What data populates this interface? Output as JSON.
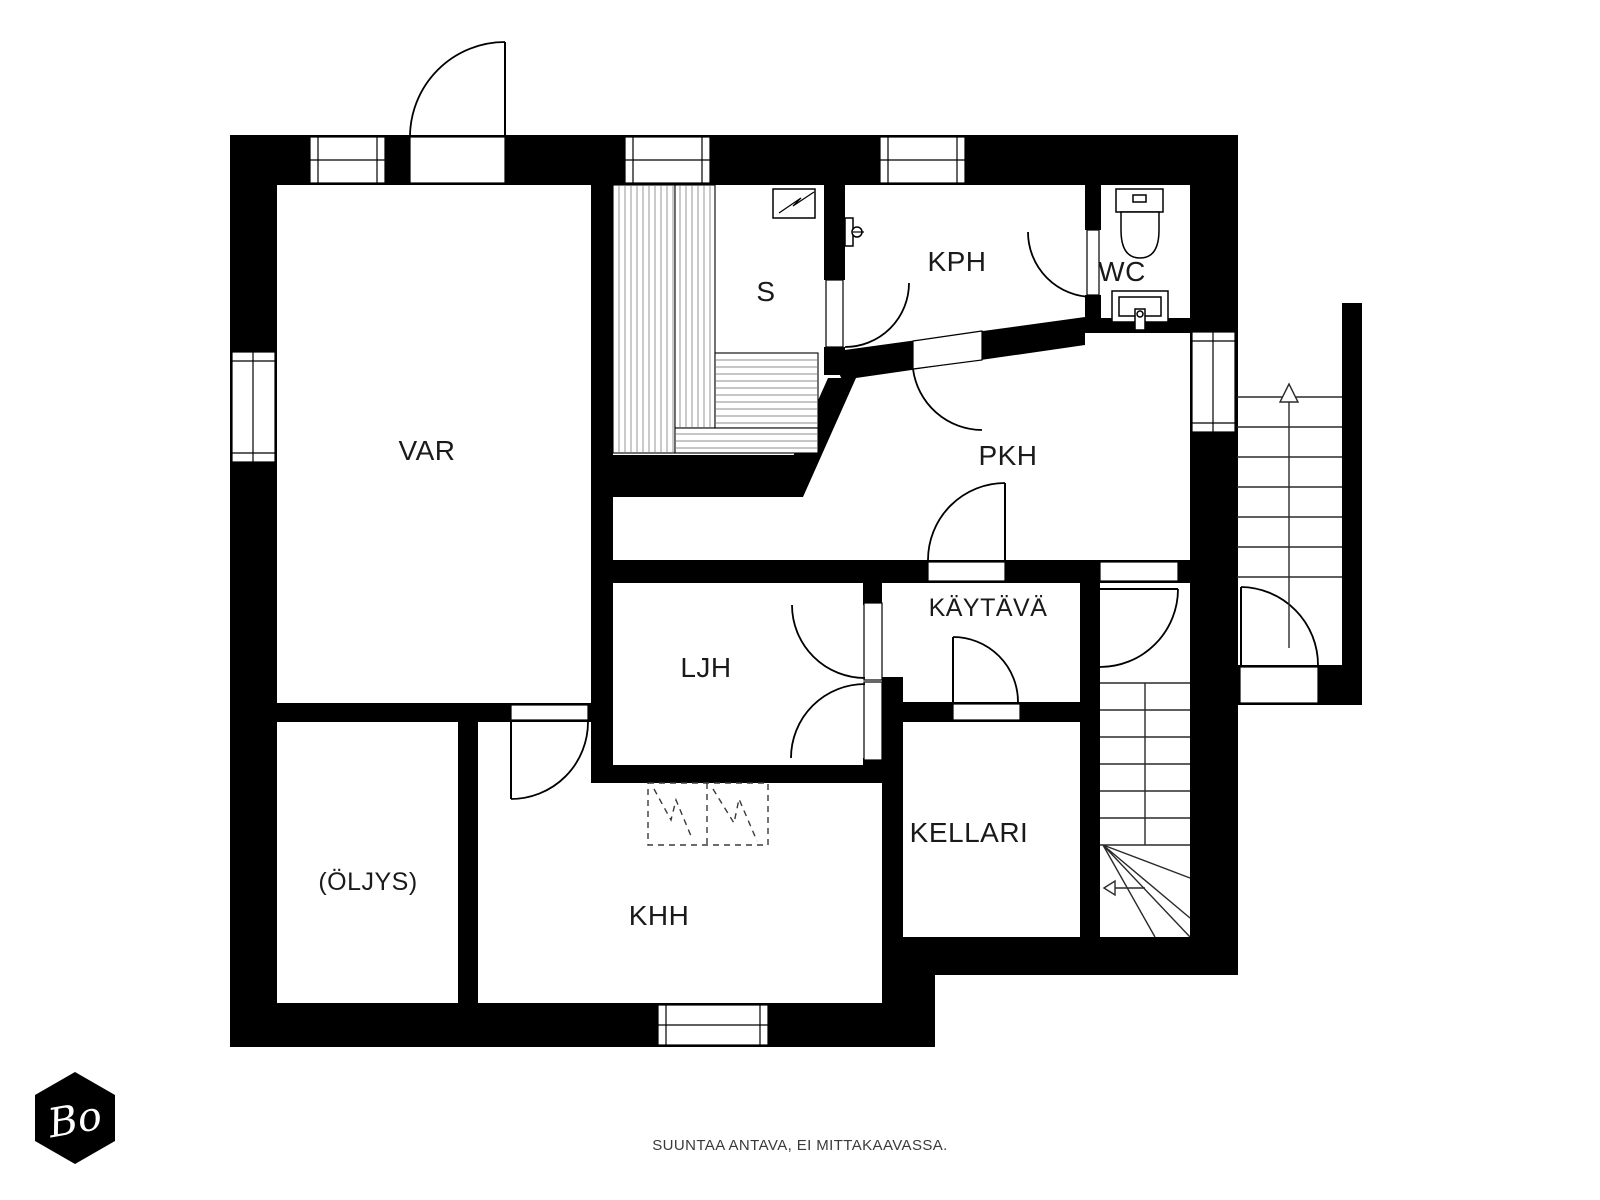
{
  "document": {
    "type": "basement floor plan",
    "language": "Finnish"
  },
  "rooms": {
    "var": "VAR",
    "s": "S",
    "kph": "KPH",
    "wc": "WC",
    "pkh": "PKH",
    "kaytava": "KÄYTÄVÄ",
    "ljh": "LJH",
    "kellari": "KELLARI",
    "oljys": "(ÖLJYS)",
    "khh": "KHH"
  },
  "footer": {
    "disclaimer": "SUUNTAA ANTAVA, EI MITTAKAAVASSA."
  },
  "logo": {
    "text": "Bo"
  },
  "colors": {
    "background": "#ffffff",
    "wall": "#000000",
    "label": "#1a1a1a",
    "footer_text": "#3a3a3a",
    "logo_bg": "#000000",
    "logo_text": "#ffffff"
  },
  "icons": {
    "stove": "sauna-stove-icon",
    "shower": "shower-icon",
    "toilet": "toilet-icon",
    "sink": "sink-icon",
    "stairs_up": "stairs-up-arrow-icon",
    "stairs_down": "stairs-down-arrow-icon"
  }
}
